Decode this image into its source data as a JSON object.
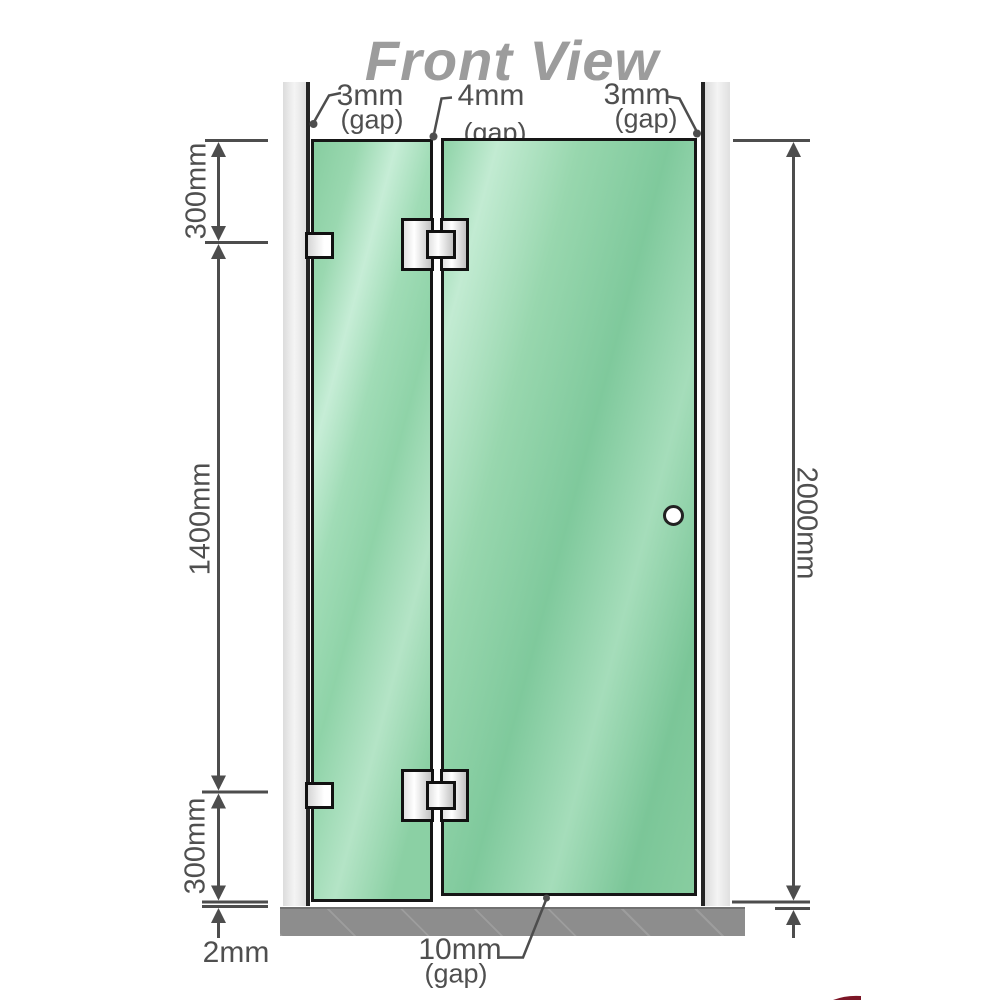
{
  "title": "Front View",
  "top_gaps": {
    "left": {
      "value": "3mm",
      "label": "(gap)"
    },
    "middle": {
      "value": "4mm",
      "label": "(gap)"
    },
    "right": {
      "value": "3mm",
      "label": "(gap)"
    }
  },
  "dimensions": {
    "left_top": "300mm",
    "left_middle": "1400mm",
    "left_bottom": "300mm",
    "bottom_left": "2mm",
    "right": "2000mm",
    "bottom_gap": {
      "value": "10mm",
      "label": "(gap)"
    }
  },
  "colors": {
    "glass_green": "#8fd3a8",
    "wall_gray": "#e8e8e8",
    "base_gray": "#8d8d8d",
    "line_gray": "#4f4f4f",
    "title_gray": "#9c9c9c",
    "accent_red": "#7c1626"
  }
}
